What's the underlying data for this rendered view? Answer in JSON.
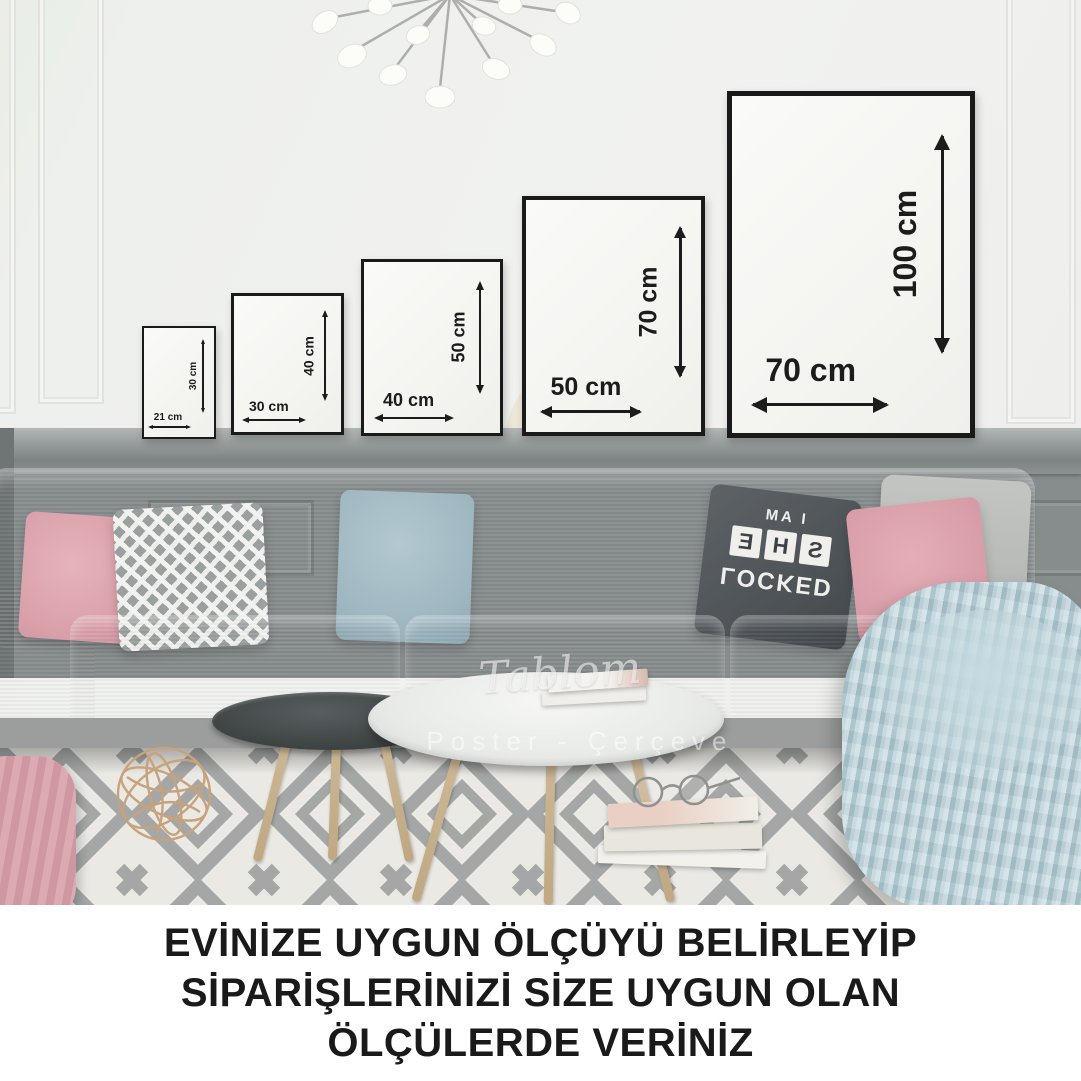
{
  "image": {
    "type": "product-photo",
    "caption": {
      "lines": [
        "EVİNİZE UYGUN ÖLÇÜYÜ BELİRLEYİP",
        "SİPARİŞLERİNİZİ SİZE UYGUN OLAN",
        "ÖLÇÜLERDE VERİNİZ"
      ]
    },
    "frames": [
      {
        "size": "21x30",
        "width_label": "21 cm",
        "height_label": "30 cm"
      },
      {
        "size": "30x40",
        "width_label": "30 cm",
        "height_label": "40 cm"
      },
      {
        "size": "40x50",
        "width_label": "40 cm",
        "height_label": "50 cm"
      },
      {
        "size": "50x70",
        "width_label": "50 cm",
        "height_label": "70 cm"
      },
      {
        "size": "70x100",
        "width_label": "70 cm",
        "height_label": "100 cm"
      }
    ],
    "watermark": {
      "script": "Tablom",
      "subtitle": "Poster - Çerçeve"
    },
    "pillow_print": {
      "line1": "I AM",
      "tiles": [
        "S",
        "H",
        "E"
      ],
      "line2": "LOCKED"
    },
    "colors": {
      "wall": "#eef0ed",
      "wainscot": "#878c8d",
      "sofa": "#b3b5b2",
      "rug_base": "#eae9e4",
      "rug_pattern": "#a4a7a5",
      "blanket": "#b6cfd6",
      "pillow_pink": "#dfa8b1",
      "pillow_blue": "#a2bac3",
      "pillow_dark": "#53585c",
      "frame_border": "#1a1a1a",
      "caption_text": "#1a1a1a"
    }
  }
}
